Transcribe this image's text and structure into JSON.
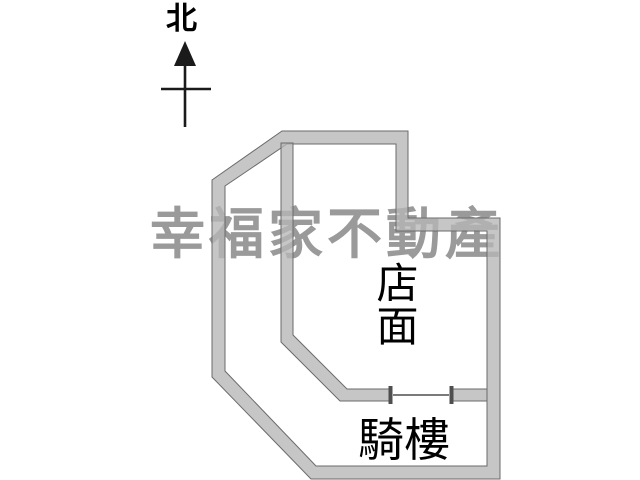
{
  "page": {
    "background": "#ffffff",
    "type": "floor-plan"
  },
  "compass": {
    "north_label": "北"
  },
  "watermark": {
    "text": "幸福家不動產",
    "color": "#9a9a9a"
  },
  "floorplan": {
    "rooms": [
      {
        "id": "storefront",
        "label": "店面",
        "orientation": "vertical"
      },
      {
        "id": "arcade",
        "label": "騎樓",
        "orientation": "horizontal"
      }
    ],
    "features": [
      {
        "id": "door-opening",
        "description": "opening between storefront and arcade"
      }
    ],
    "colors": {
      "wall_fill": "rgba(182,182,182,0.78)",
      "wall_outline": "#6b6b6b",
      "door": "#4f4f4f",
      "line": "#1a1a1a",
      "label_text": "#000000"
    }
  }
}
